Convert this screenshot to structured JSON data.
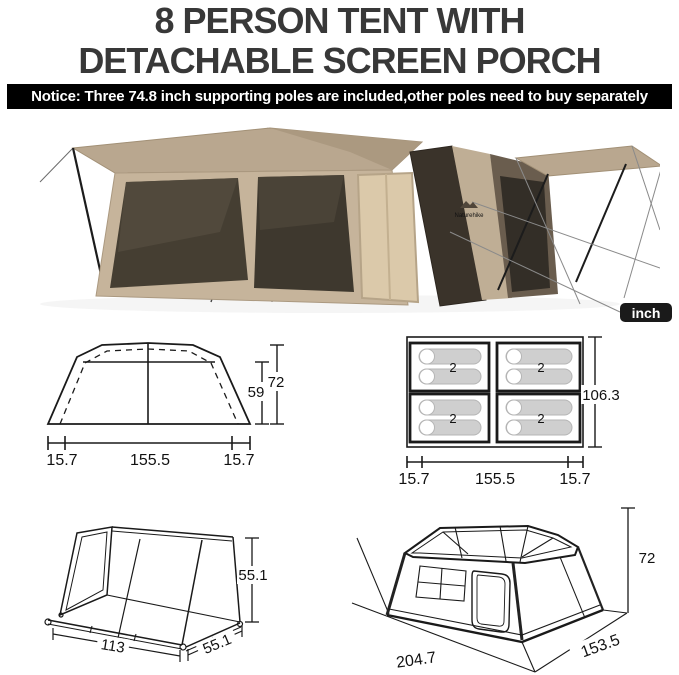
{
  "header": {
    "title_line1": "8 PERSON TENT WITH",
    "title_line2": "DETACHABLE SCREEN PORCH"
  },
  "notice": {
    "text": "Notice: Three 74.8 inch supporting poles are included,other poles need to buy separately"
  },
  "unit_badge": {
    "label": "inch"
  },
  "photo": {
    "brand_logo": "Naturehike"
  },
  "colors": {
    "tent_tan": "#bdab92",
    "tent_wall": "#c6b49b",
    "tent_dark_window": "#3e382e",
    "tent_interior": "#dbc9aa",
    "tent_dark_brown": "#675a4a",
    "line_color": "#1a1a1a",
    "notice_bg": "#000000",
    "badge_bg": "#1a1a1a"
  },
  "diagrams": {
    "front_view": {
      "inner_height": "59",
      "total_height": "72",
      "seg_left": "15.7",
      "seg_mid": "155.5",
      "seg_right": "15.7"
    },
    "floor_plan": {
      "depth": "106.3",
      "seg_left": "15.7",
      "seg_mid": "155.5",
      "seg_right": "15.7",
      "pads": [
        "2",
        "2",
        "2",
        "2"
      ]
    },
    "porch_frame": {
      "height": "55.1",
      "width": "113",
      "depth": "55.1"
    },
    "tent_3d": {
      "height": "72",
      "depth": "153.5",
      "width": "204.7"
    }
  }
}
